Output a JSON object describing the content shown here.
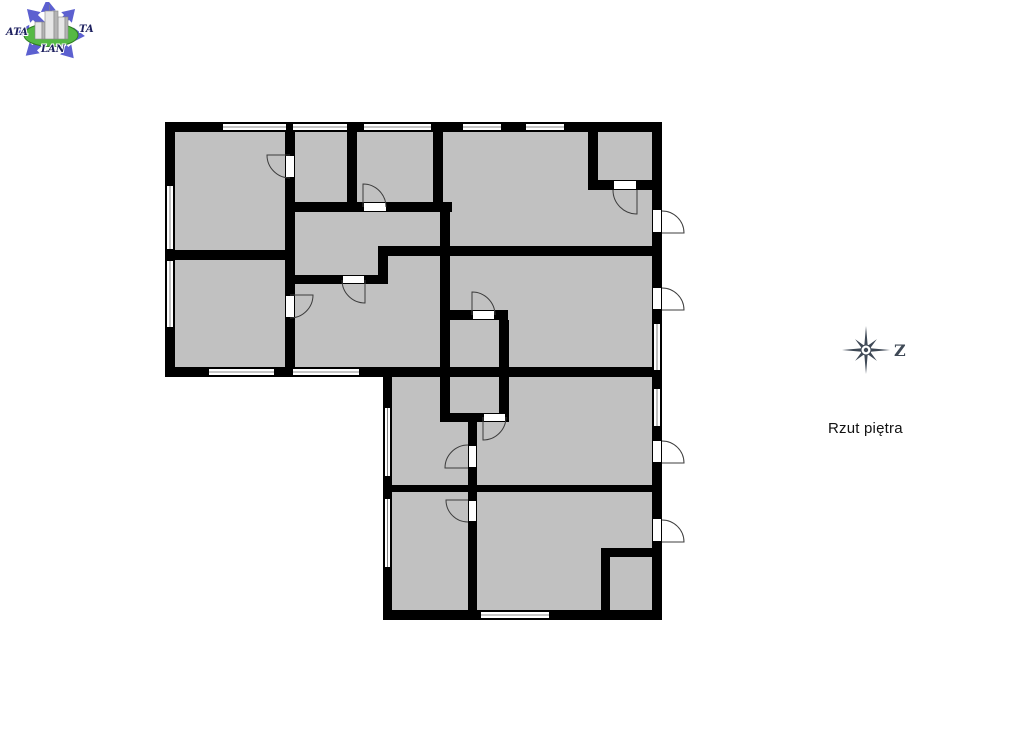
{
  "page": {
    "title": "Rzut piętra"
  },
  "logo": {
    "text_left": "ATA",
    "text_right": "TA",
    "text_bottom": "LAN",
    "arrow_color": "#5c60d0",
    "ellipse_color": "#55b944",
    "ellipse_edge": "#2f7d22",
    "text_color": "#1f2260",
    "building_front": "#e6e6e6",
    "building_side": "#b4b4b4",
    "building_edge": "#858585"
  },
  "compass": {
    "label": "Z",
    "color": "#3f4956"
  },
  "floorplan": {
    "floor_color": "#c1c1c1",
    "wall_color": "#000000",
    "opening_color": "#ffffff",
    "frame_color": "#000000",
    "window_midline_color": "#666666",
    "arc_color": "#3c3c3c",
    "floors": [
      [
        170,
        127,
        487,
        245
      ],
      [
        387,
        372,
        270,
        244
      ]
    ],
    "walls": [
      [
        165,
        122,
        497,
        10
      ],
      [
        165,
        122,
        10,
        255
      ],
      [
        165,
        367,
        497,
        10
      ],
      [
        652,
        122,
        10,
        498
      ],
      [
        383,
        367,
        9,
        253
      ],
      [
        383,
        610,
        279,
        10
      ],
      [
        285,
        122,
        10,
        246
      ],
      [
        347,
        122,
        10,
        90
      ],
      [
        433,
        122,
        10,
        90
      ],
      [
        588,
        122,
        10,
        68
      ],
      [
        588,
        180,
        74,
        10
      ],
      [
        285,
        202,
        167,
        10
      ],
      [
        440,
        202,
        10,
        220
      ],
      [
        165,
        250,
        130,
        10
      ],
      [
        285,
        275,
        103,
        9
      ],
      [
        378,
        246,
        10,
        38
      ],
      [
        378,
        246,
        284,
        10
      ],
      [
        440,
        310,
        68,
        10
      ],
      [
        499,
        320,
        10,
        102
      ],
      [
        440,
        413,
        68,
        9
      ],
      [
        468,
        422,
        9,
        190
      ],
      [
        383,
        485,
        279,
        7
      ],
      [
        601,
        548,
        61,
        9
      ],
      [
        601,
        548,
        9,
        72
      ]
    ],
    "windows": [
      [
        222,
        123,
        65,
        8,
        "h"
      ],
      [
        292,
        123,
        56,
        8,
        "h"
      ],
      [
        363,
        123,
        69,
        8,
        "h"
      ],
      [
        462,
        123,
        40,
        8,
        "h"
      ],
      [
        525,
        123,
        40,
        8,
        "h"
      ],
      [
        208,
        368,
        67,
        8,
        "h"
      ],
      [
        292,
        368,
        68,
        8,
        "h"
      ],
      [
        480,
        611,
        70,
        8,
        "h"
      ],
      [
        166,
        185,
        8,
        65,
        "v"
      ],
      [
        166,
        260,
        8,
        68,
        "v"
      ],
      [
        384,
        407,
        7,
        70,
        "v"
      ],
      [
        384,
        498,
        7,
        70,
        "v"
      ],
      [
        653,
        323,
        8,
        48,
        "v"
      ],
      [
        653,
        388,
        8,
        39,
        "v"
      ]
    ],
    "door_openings": [
      [
        285,
        155,
        10,
        23
      ],
      [
        363,
        202,
        24,
        10
      ],
      [
        342,
        275,
        23,
        9
      ],
      [
        613,
        180,
        24,
        10
      ],
      [
        472,
        310,
        23,
        10
      ],
      [
        285,
        295,
        10,
        23
      ],
      [
        652,
        209,
        10,
        24
      ],
      [
        652,
        287,
        10,
        23
      ],
      [
        483,
        413,
        23,
        9
      ],
      [
        468,
        445,
        9,
        23
      ],
      [
        652,
        440,
        10,
        23
      ],
      [
        468,
        500,
        9,
        22
      ],
      [
        652,
        518,
        10,
        24
      ]
    ],
    "door_swings": [
      "M290,155 L267,155 A23 23 0 0 0 290,178",
      "M363,207 L363,184 A23 23 0 0 1 386,207",
      "M365,280 L365,303 A23 23 0 0 1 342,280",
      "M637,190 L637,214 A24 24 0 0 1 613,190",
      "M472,315 L472,292 A23 23 0 0 1 495,315",
      "M290,295 L313,295 A23 23 0 0 1 290,318",
      "M662,233 L684,233 A22 22 0 0 0 662,211",
      "M662,310 L684,310 A22 22 0 0 0 662,288",
      "M483,417 L483,440 A23 23 0 0 0 506,417",
      "M468,468 L445,468 A23 23 0 0 1 468,445",
      "M662,463 L684,463 A22 22 0 0 0 662,441",
      "M468,500 L446,500 A22 22 0 0 0 468,522",
      "M662,542 L684,542 A22 22 0 0 0 662,520"
    ]
  }
}
